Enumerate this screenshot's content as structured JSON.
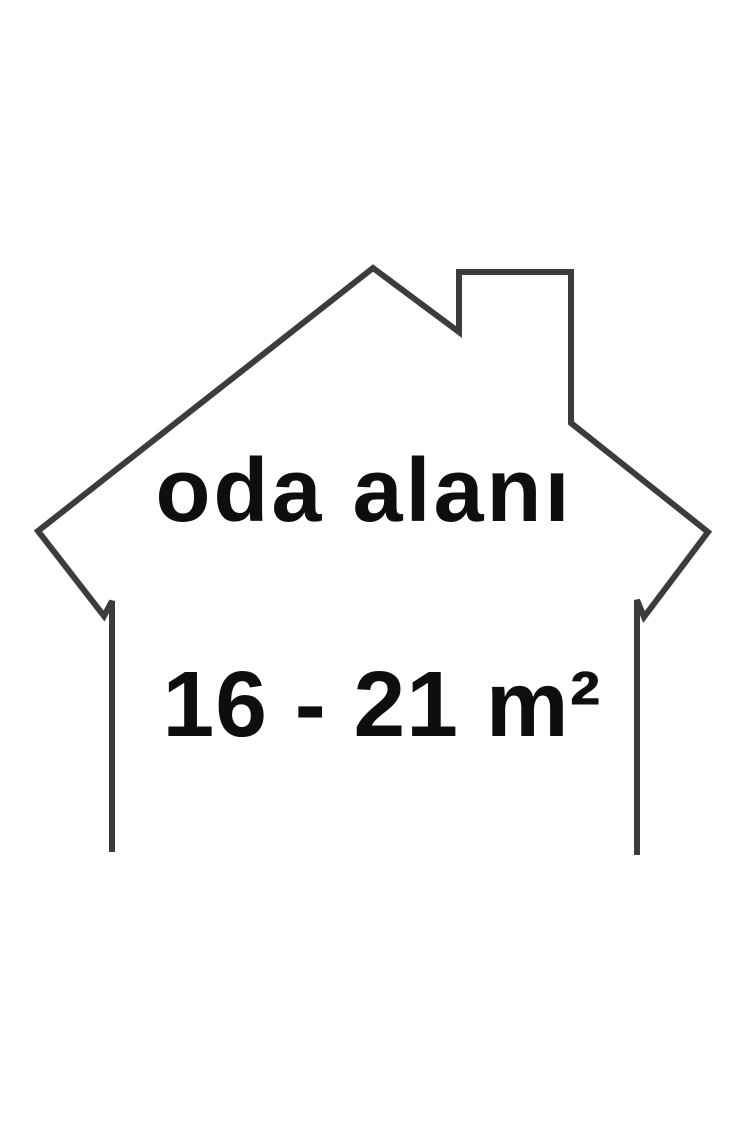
{
  "figure": {
    "label": "oda alanı",
    "area": "16 - 21 m²",
    "area_min": "16",
    "area_max": "21",
    "area_unit": "m²"
  },
  "colors": {
    "background": "#ffffff",
    "outline": "#3c3c3c",
    "text": "#0e0e0e"
  }
}
